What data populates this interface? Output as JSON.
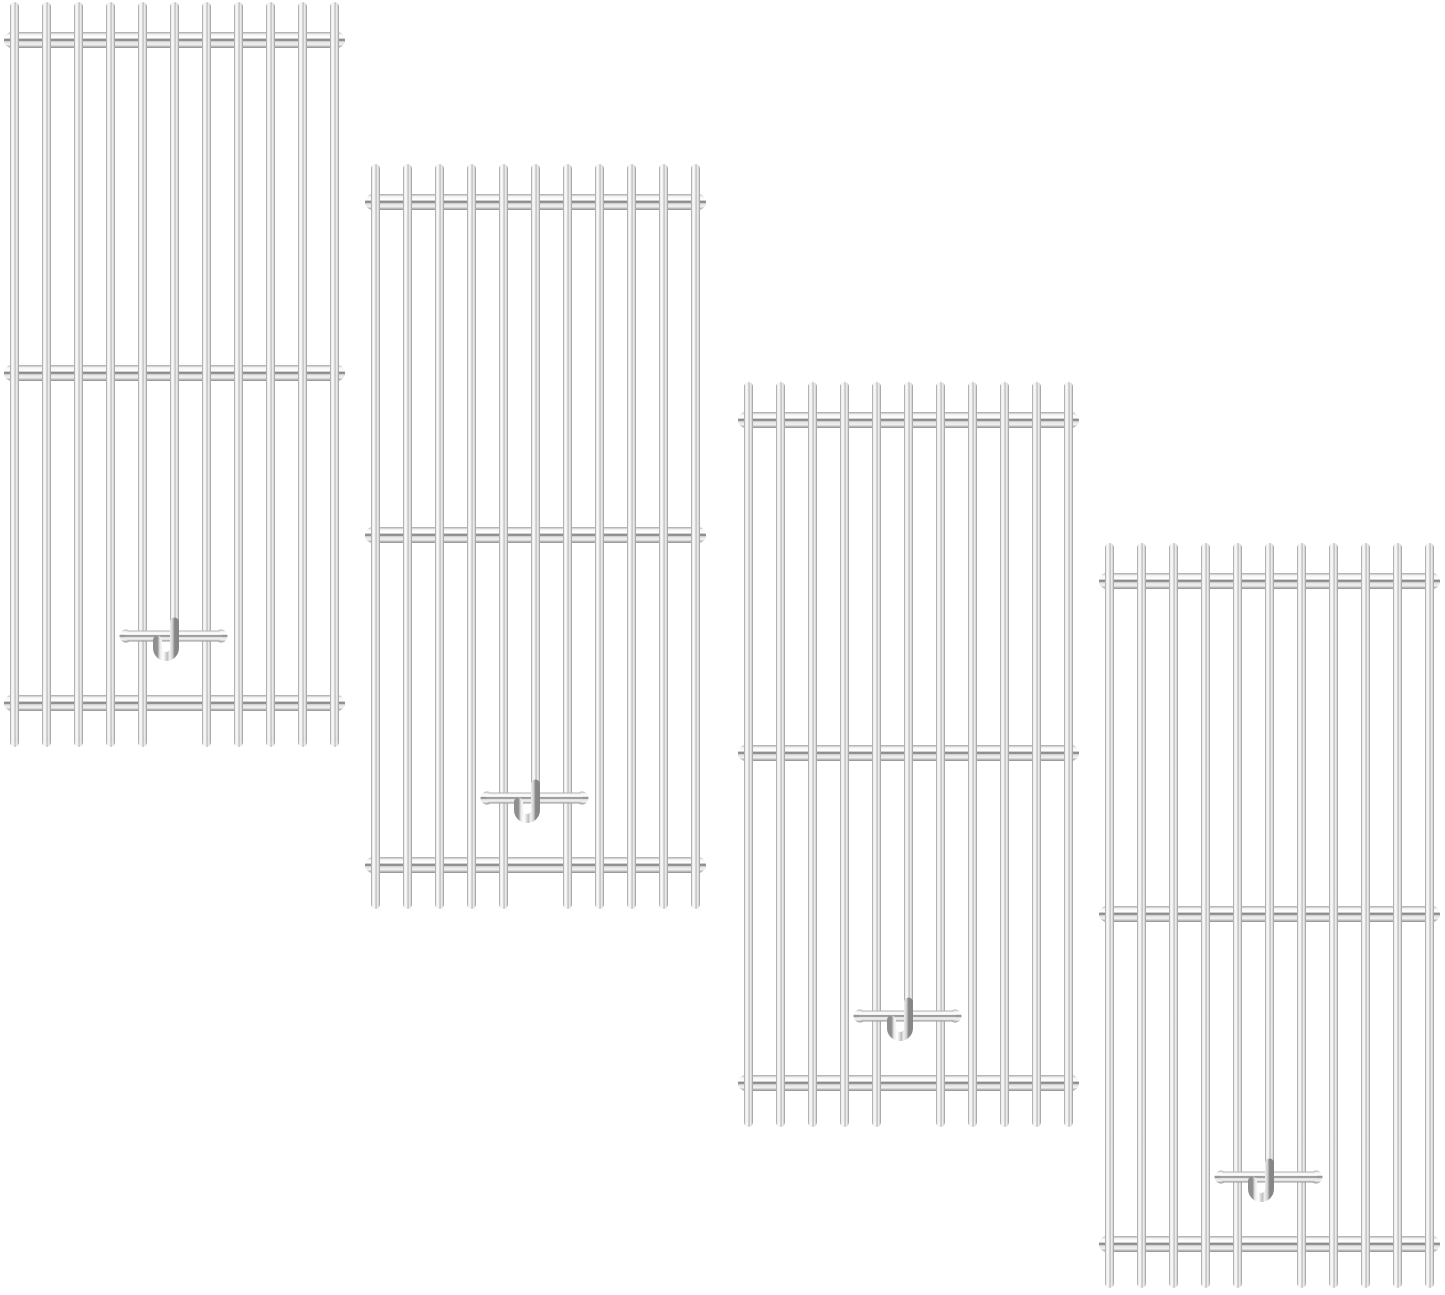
{
  "scene": {
    "type": "product-photo",
    "description": "Four identical stainless steel grill cooking grates arranged diagonally from top-left to bottom-right on a plain white background",
    "background_color": "#ffffff",
    "item_count": 4
  },
  "grate_spec": {
    "width": 341,
    "height": 748,
    "bar_count": 11,
    "bar_width": 9,
    "bar_inset": 6,
    "bar_length": 745,
    "crossbar_y_centers": [
      38,
      371,
      701
    ],
    "crossbar_height": 16,
    "nub_radius": 5.5,
    "handle": {
      "x_start": 121,
      "x_end": 218,
      "y_center": 634,
      "height": 11,
      "knob_radius": 6.5
    },
    "short_bar_index": 5,
    "hook": {
      "straight_end_y": 628,
      "turn_y": 646,
      "radius": 8.5,
      "tip_y": 638
    }
  },
  "gradients": {
    "bar": [
      [
        "0",
        "#8f8f8f"
      ],
      [
        "0.14",
        "#e9e9e9"
      ],
      [
        "0.34",
        "#ffffff"
      ],
      [
        "0.5",
        "#d6d6d6"
      ],
      [
        "0.58",
        "#bdbdbd"
      ],
      [
        "0.72",
        "#f3f3f3"
      ],
      [
        "0.9",
        "#c9c9c9"
      ],
      [
        "1",
        "#868686"
      ]
    ],
    "crossbar": [
      [
        "0",
        "#a6a6a6"
      ],
      [
        "0.16",
        "#f5f5f5"
      ],
      [
        "0.36",
        "#ffffff"
      ],
      [
        "0.5",
        "#6f6f6f"
      ],
      [
        "0.6",
        "#dedede"
      ],
      [
        "0.78",
        "#f4f4f4"
      ],
      [
        "1",
        "#8d8d8d"
      ]
    ],
    "steel_dark": "#868686",
    "steel_light": "#ffffff"
  },
  "grates": [
    {
      "id": "grate-1",
      "x": 4,
      "y": 2
    },
    {
      "id": "grate-2",
      "x": 365,
      "y": 164
    },
    {
      "id": "grate-3",
      "x": 738,
      "y": 382
    },
    {
      "id": "grate-4",
      "x": 1099,
      "y": 543
    }
  ]
}
